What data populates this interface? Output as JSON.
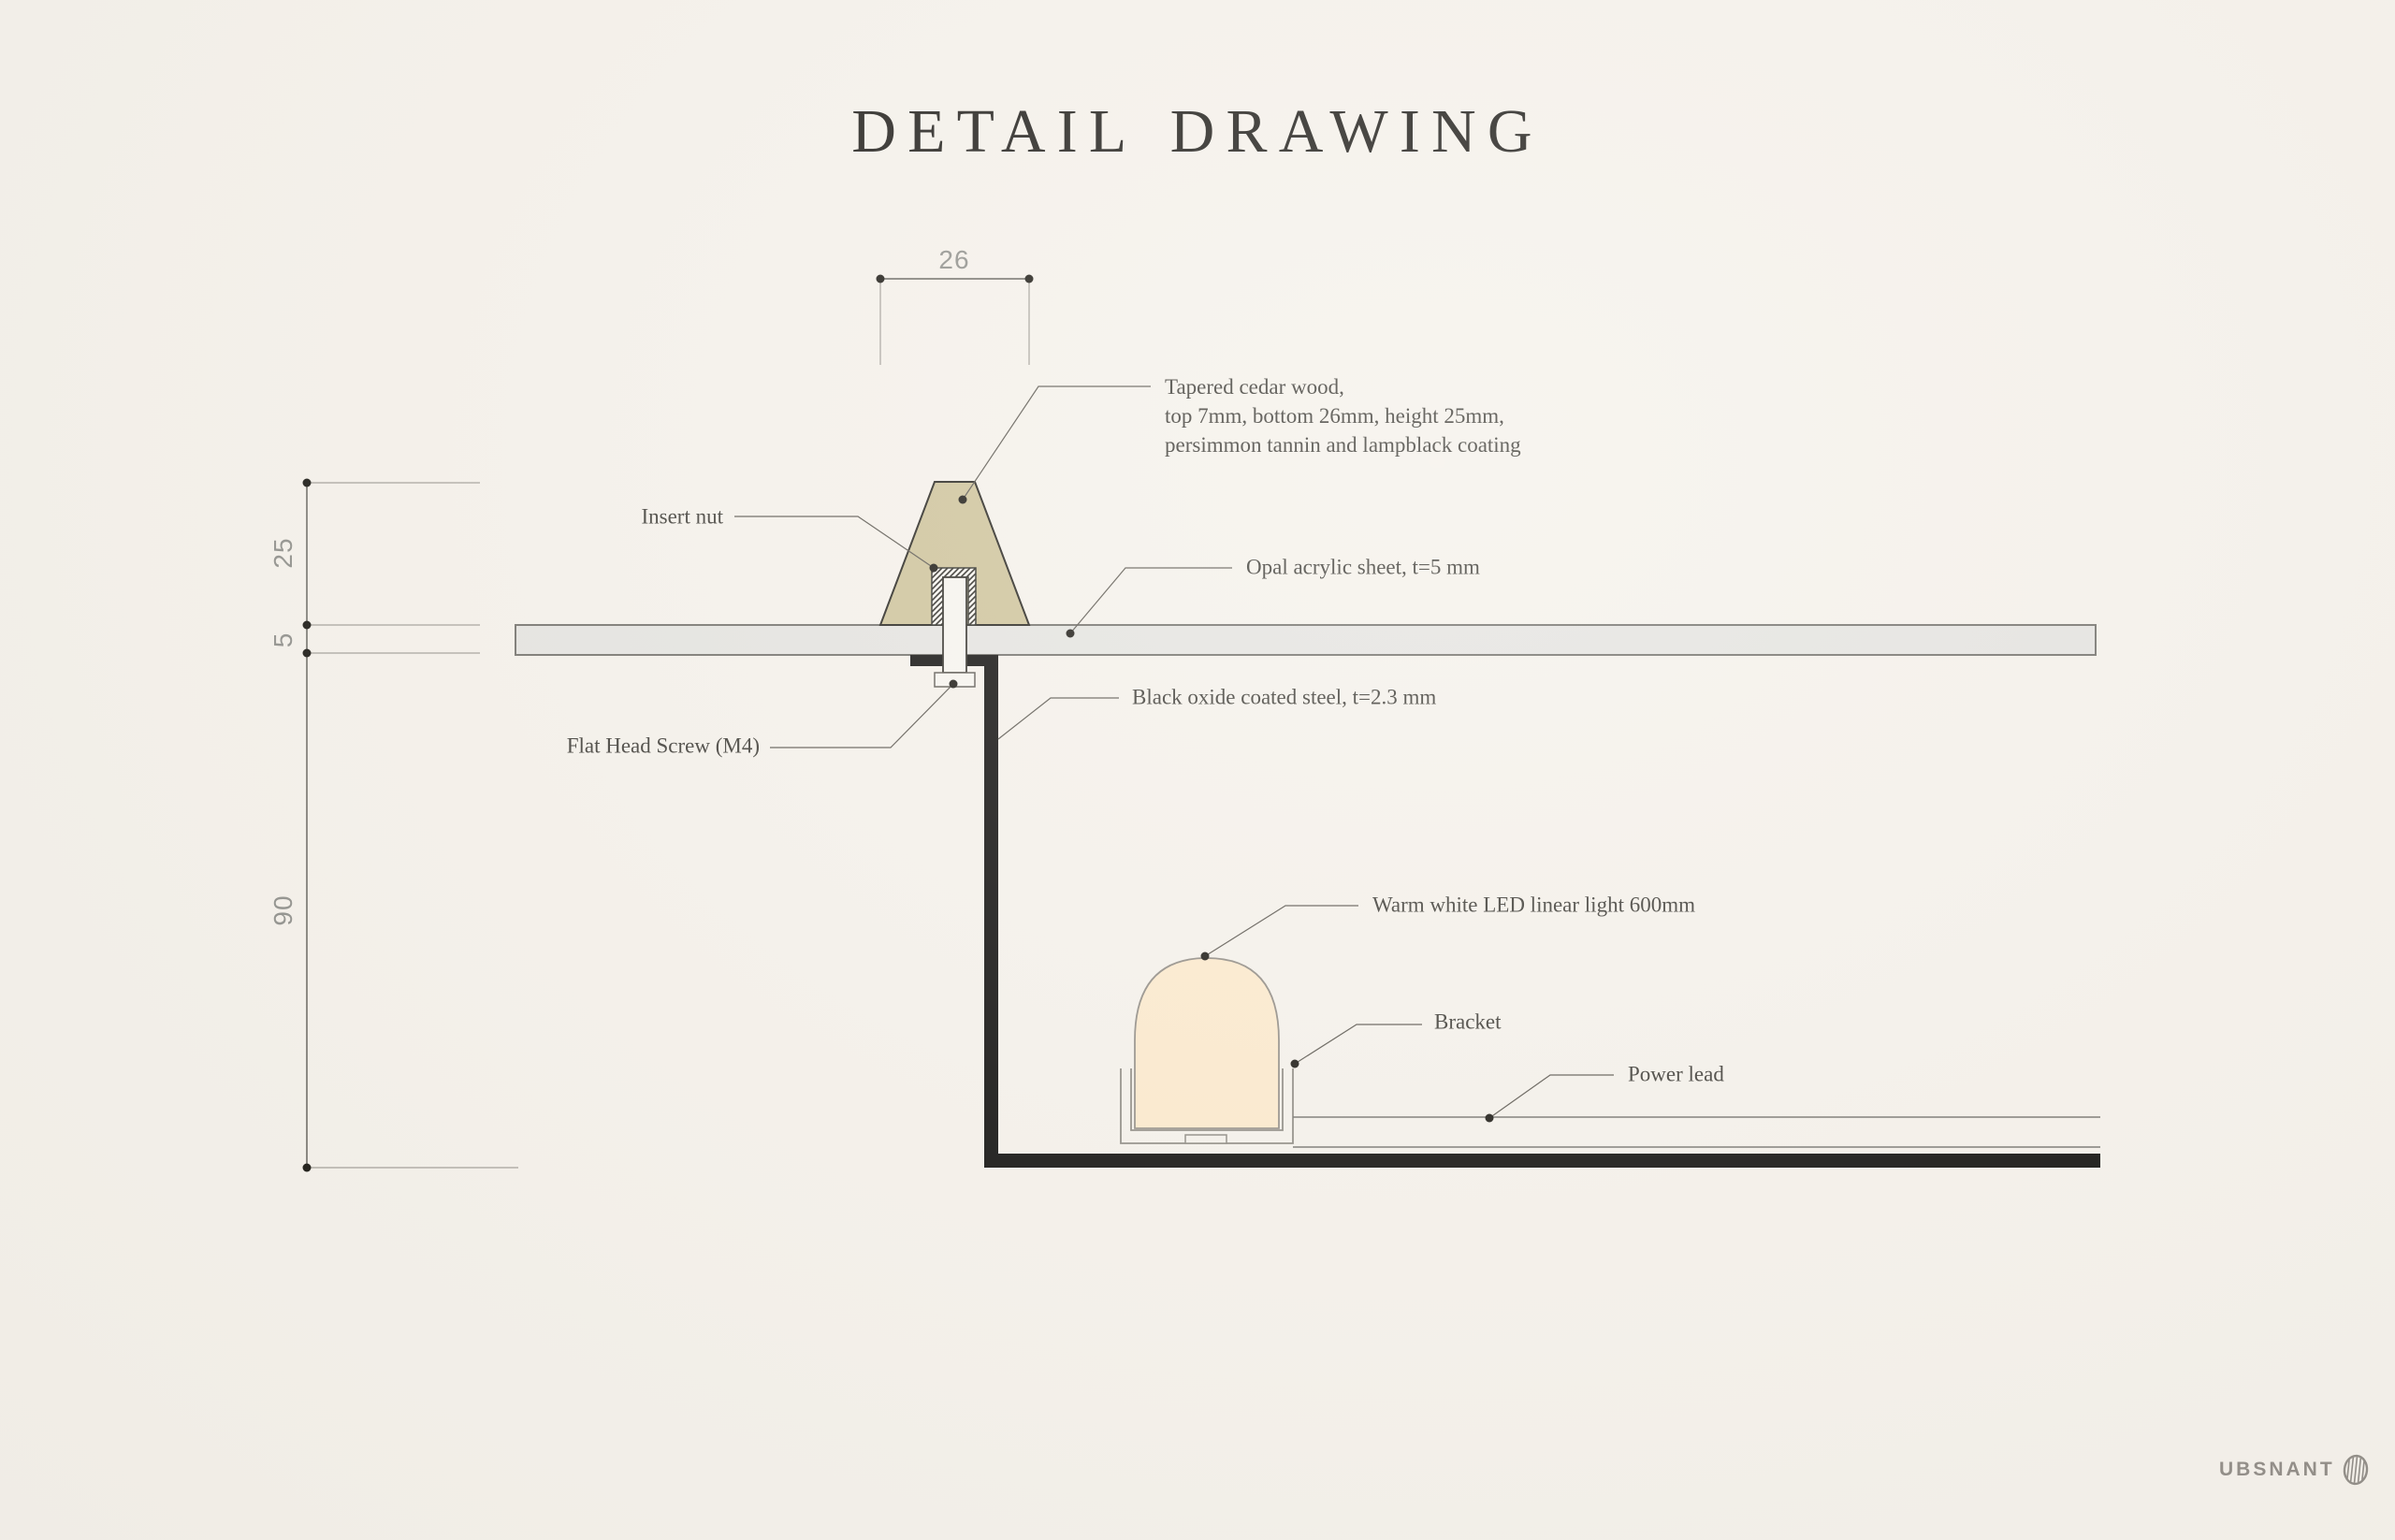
{
  "title": "DETAIL DRAWING",
  "dimensions": {
    "top_width": "26",
    "wood_height": "25",
    "acrylic_thickness": "5",
    "cavity_depth": "90"
  },
  "labels": {
    "cedar_line1": "Tapered cedar wood,",
    "cedar_line2": "top 7mm, bottom 26mm, height 25mm,",
    "cedar_line3": "persimmon tannin and lampblack coating",
    "insert_nut": "Insert nut",
    "acrylic": "Opal acrylic sheet, t=5 mm",
    "steel": "Black oxide coated steel, t=2.3 mm",
    "screw": "Flat Head Screw (M4)",
    "led": "Warm white LED linear light 600mm",
    "bracket": "Bracket",
    "power_lead": "Power lead"
  },
  "logo": {
    "text": "UBSNANT"
  },
  "colors": {
    "background": "#f5f1ea",
    "wood": "#cdc298",
    "acrylic": "#e4e3df",
    "steel": "#0c0b09",
    "led": "#fce9cb",
    "label_text": "#3b3933",
    "dimension_text": "#8e8e89",
    "logo": "#8f8a84"
  }
}
